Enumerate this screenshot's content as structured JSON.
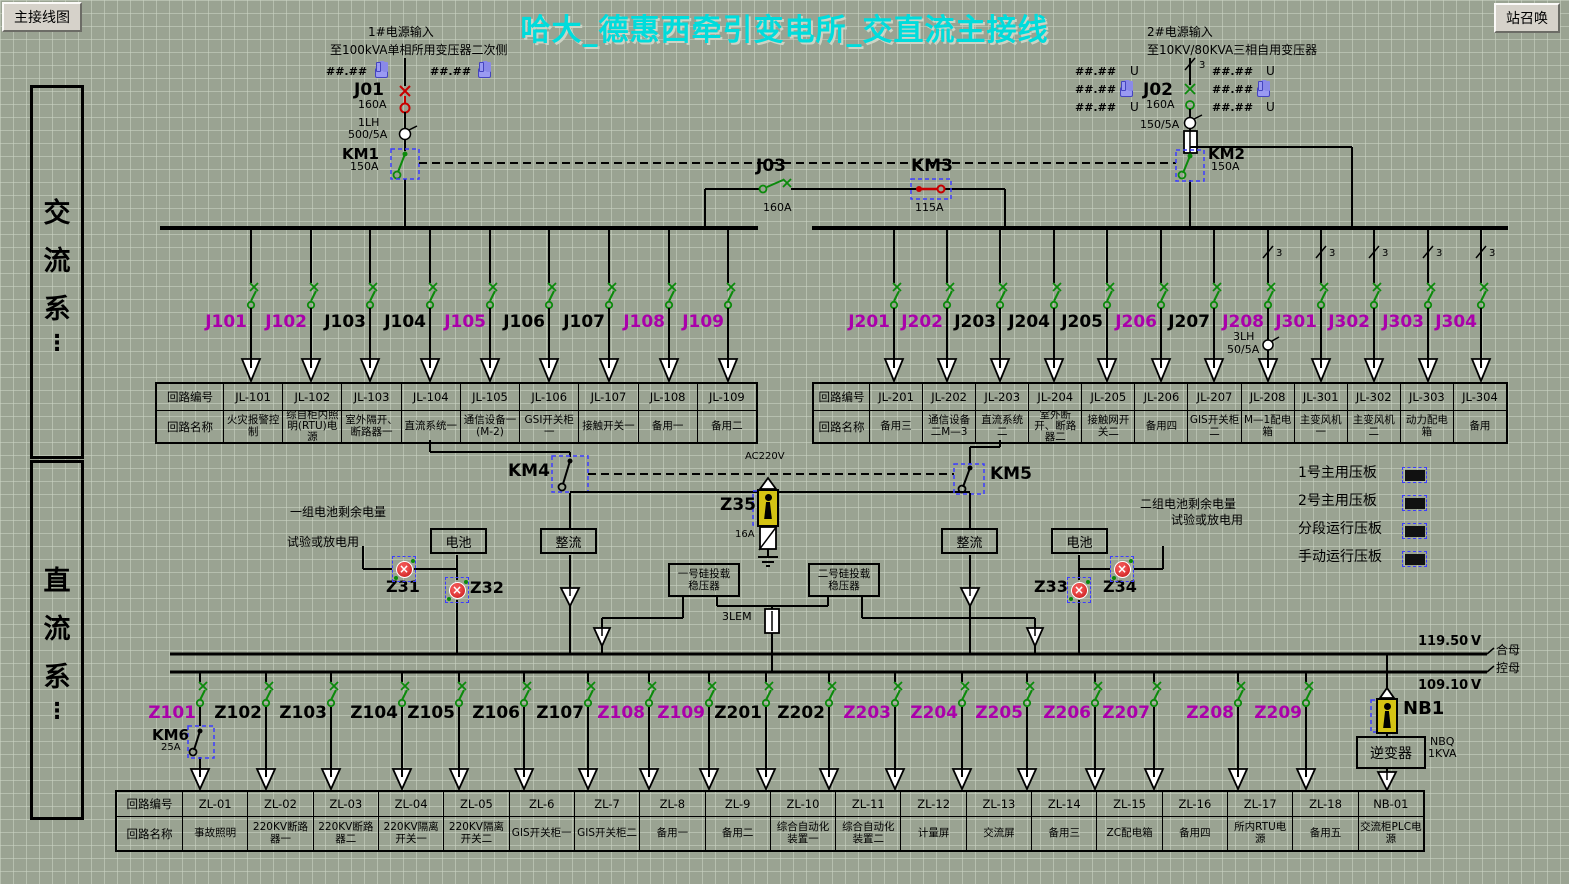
{
  "header": {
    "left_button": "主接线图",
    "right_button": "站召唤",
    "title": "哈大_德惠西牵引变电所_交直流主接线"
  },
  "sidebar": {
    "ac": "交流系",
    "dc": "直流系",
    "ellipsis": "⋮"
  },
  "source1": {
    "line1": "1#电源输入",
    "line2": "至100kVA单相所用变压器二次侧",
    "m1": "##.##",
    "m2": "##.##",
    "breaker": "J01",
    "breaker_a": "160A",
    "ct": "1LH",
    "ct_ratio": "500/5A",
    "km": "KM1",
    "km_a": "150A"
  },
  "source2": {
    "line1": "2#电源输入",
    "line2": "至10KV/80KVA三相自用变压器",
    "lm": [
      "##.##",
      "##.##",
      "##.##"
    ],
    "rm": [
      "##.##",
      "##.##",
      "##.##"
    ],
    "u": "U",
    "phase": "3",
    "breaker": "J02",
    "breaker_a": "160A",
    "ct_ratio": "150/5A",
    "km": "KM2",
    "km_a": "150A"
  },
  "tie": {
    "s1": "J03",
    "s1_a": "160A",
    "s2": "KM3",
    "s2_a": "115A"
  },
  "table_headers": {
    "row1": "回路编号",
    "row2": "回路名称"
  },
  "ac_left": {
    "feeders": [
      {
        "label": "J101",
        "color": "#aa00aa"
      },
      {
        "label": "J102",
        "color": "#aa00aa"
      },
      {
        "label": "J103",
        "color": "#000000"
      },
      {
        "label": "J104",
        "color": "#000000"
      },
      {
        "label": "J105",
        "color": "#aa00aa"
      },
      {
        "label": "J106",
        "color": "#000000"
      },
      {
        "label": "J107",
        "color": "#000000"
      },
      {
        "label": "J108",
        "color": "#aa00aa"
      },
      {
        "label": "J109",
        "color": "#aa00aa"
      }
    ],
    "ids": [
      "JL-101",
      "JL-102",
      "JL-103",
      "JL-104",
      "JL-105",
      "JL-106",
      "JL-107",
      "JL-108",
      "JL-109"
    ],
    "names": [
      "火灾报警控制",
      "综自柜内照明(RTU)电源",
      "室外隔开、断路器一",
      "直流系统一",
      "通信设备一(M-2)",
      "GSI开关柜一",
      "接触开关一",
      "备用一",
      "备用二"
    ]
  },
  "ac_right": {
    "feeders": [
      {
        "label": "J201",
        "color": "#aa00aa"
      },
      {
        "label": "J202",
        "color": "#aa00aa"
      },
      {
        "label": "J203",
        "color": "#000000"
      },
      {
        "label": "J204",
        "color": "#000000"
      },
      {
        "label": "J205",
        "color": "#000000"
      },
      {
        "label": "J206",
        "color": "#aa00aa"
      },
      {
        "label": "J207",
        "color": "#000000"
      },
      {
        "label": "J208",
        "color": "#aa00aa"
      },
      {
        "label": "J301",
        "color": "#aa00aa"
      },
      {
        "label": "J302",
        "color": "#aa00aa"
      },
      {
        "label": "J303",
        "color": "#aa00aa"
      },
      {
        "label": "J304",
        "color": "#aa00aa"
      }
    ],
    "ct": "3LH",
    "ct_ratio": "50/5A",
    "phase": "3",
    "ids": [
      "JL-201",
      "JL-202",
      "JL-203",
      "JL-204",
      "JL-205",
      "JL-206",
      "JL-207",
      "JL-208",
      "JL-301",
      "JL-302",
      "JL-303",
      "JL-304"
    ],
    "names": [
      "备用三",
      "通信设备二M—3",
      "直流系统二",
      "室外断开、断路器二",
      "接触网开关二",
      "备用四",
      "GIS开关柜二",
      "M—1配电箱",
      "主变风机一",
      "主变风机二",
      "动力配电箱",
      "备用"
    ]
  },
  "dc_link": {
    "km4": "KM4",
    "km5": "KM5",
    "ac220": "AC220V",
    "z35": "Z35",
    "z35_fuse": "16A",
    "battery": "电池",
    "rectifier": "整流",
    "bat1_charge": "一组电池剩余电量",
    "bat1_test": "试验或放电用",
    "bat2_charge": "二组电池剩余电量",
    "bat2_test": "试验或放电用",
    "z31": "Z31",
    "z32": "Z32",
    "z33": "Z33",
    "z34": "Z34",
    "stab1": "一号硅投载稳压器",
    "stab2": "二号硅投载稳压器",
    "fuse": "3LEM"
  },
  "dc_bus": {
    "v_top": "119.50",
    "v_bottom": "109.10",
    "unit": "V",
    "bus_top": "合母",
    "bus_bottom": "控母"
  },
  "plates": [
    "1号主用压板",
    "2号主用压板",
    "分段运行压板",
    "手动运行压板"
  ],
  "dc": {
    "feeders": [
      {
        "label": "Z101",
        "color": "#aa00aa"
      },
      {
        "label": "Z102",
        "color": "#000000"
      },
      {
        "label": "Z103",
        "color": "#000000"
      },
      {
        "label": "Z104",
        "color": "#000000"
      },
      {
        "label": "Z105",
        "color": "#000000"
      },
      {
        "label": "Z106",
        "color": "#000000"
      },
      {
        "label": "Z107",
        "color": "#000000"
      },
      {
        "label": "Z108",
        "color": "#aa00aa"
      },
      {
        "label": "Z109",
        "color": "#aa00aa"
      },
      {
        "label": "Z201",
        "color": "#000000"
      },
      {
        "label": "Z202",
        "color": "#000000"
      },
      {
        "label": "Z203",
        "color": "#aa00aa"
      },
      {
        "label": "Z204",
        "color": "#aa00aa"
      },
      {
        "label": "Z205",
        "color": "#aa00aa"
      },
      {
        "label": "Z206",
        "color": "#aa00aa"
      },
      {
        "label": "Z207",
        "color": "#aa00aa"
      },
      {
        "label": "Z208",
        "color": "#aa00aa"
      },
      {
        "label": "Z209",
        "color": "#aa00aa"
      }
    ],
    "km6": "KM6",
    "km6_a": "25A",
    "ids": [
      "ZL-01",
      "ZL-02",
      "ZL-03",
      "ZL-04",
      "ZL-05",
      "ZL-6",
      "ZL-7",
      "ZL-8",
      "ZL-9",
      "ZL-10",
      "ZL-11",
      "ZL-12",
      "ZL-13",
      "ZL-14",
      "ZL-15",
      "ZL-16",
      "ZL-17",
      "ZL-18",
      "NB-01"
    ],
    "names": [
      "事故照明",
      "220KV断路器一",
      "220KV断路器二",
      "220KV隔离开关一",
      "220KV隔离开关二",
      "GIS开关柜一",
      "GIS开关柜二",
      "备用一",
      "备用二",
      "综合自动化装置一",
      "综合自动化装置二",
      "计量屏",
      "交流屏",
      "备用三",
      "ZC配电箱",
      "备用四",
      "所内RTU电源",
      "备用五",
      "交流柜PLC电源"
    ]
  },
  "nb1": {
    "label": "NB1",
    "inverter": "逆变器",
    "r1": "NBQ",
    "r2": "1KVA"
  }
}
